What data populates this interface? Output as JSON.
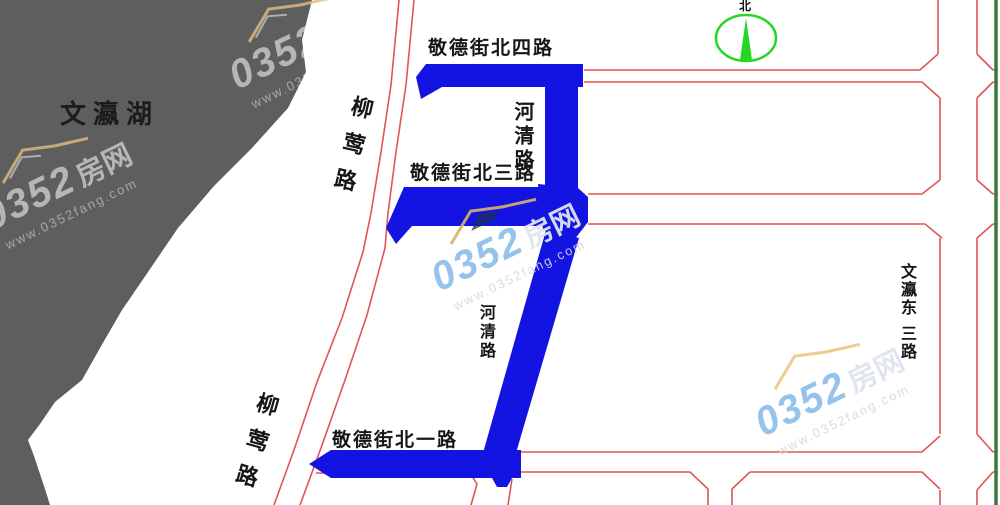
{
  "map": {
    "lake_label": "文瀛湖",
    "compass_north_label": "北",
    "roads": {
      "jingde_north_4": "敬德街北四路",
      "jingde_north_3": "敬德街北三路",
      "jingde_north_1": "敬德街北一路",
      "heqing_upper": "河清路",
      "heqing_lower": "河清路",
      "liuying_upper": "柳莺路",
      "liuying_lower": "柳莺路",
      "wenying_east_line1": "文瀛东",
      "wenying_east_line2": "三路"
    }
  },
  "watermark": {
    "num": "0352",
    "suffix": "房网",
    "url": "www.0352fang.com"
  },
  "colors": {
    "highlight_road_blue": "#1414e2",
    "parcel_line_red": "#e05454",
    "lake_gray": "#5e5e5e",
    "compass_green": "#25d625",
    "east_boundary_green": "#3b7a3b"
  }
}
